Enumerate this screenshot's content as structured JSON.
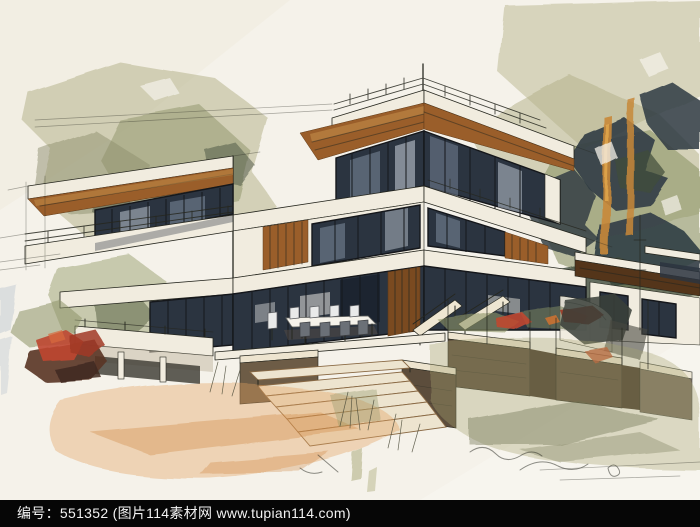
{
  "footer": {
    "text": "编号：551352 (图片114素材网 www.tupian114.com)"
  },
  "palette": {
    "paper": "#f5f2ea",
    "paper_warm": "#efe8d8",
    "ink": "#26271f",
    "slab": "#f1ecdf",
    "slab_shade": "#c9bfab",
    "wood": "#9a5e2a",
    "wood_mid": "#8a6a45",
    "wood_light": "#c68f4a",
    "wood_dark": "#5f3a18",
    "wing_roof": "#54351a",
    "glass": "#2b3440",
    "glass_mid": "#8593a6",
    "glass_light": "#ccd4dd",
    "mullion": "#15171b",
    "fol_dark": "#2e3a42",
    "fol_green": "#3f4b3b",
    "fol_sage": "#8d9468",
    "fol_olive": "#b2b086",
    "trunk": "#c8883a",
    "trunk_light": "#e3a94f",
    "red": "#bf4730",
    "red_deep": "#a13824",
    "maroon": "#5a3426",
    "sand": "#e2a05f",
    "sand_deep": "#cf883e",
    "stone": "#5c4d3c",
    "stone_side": "#473a2b",
    "stone_light": "#6d5c46",
    "cap": "#ede4cf",
    "olive_wash": "#a5a470",
    "olive_deep": "#6e7150",
    "blue_gray": "#9fb0c4",
    "footer_bg": "#060606",
    "footer_fg": "#f2f2f2"
  }
}
